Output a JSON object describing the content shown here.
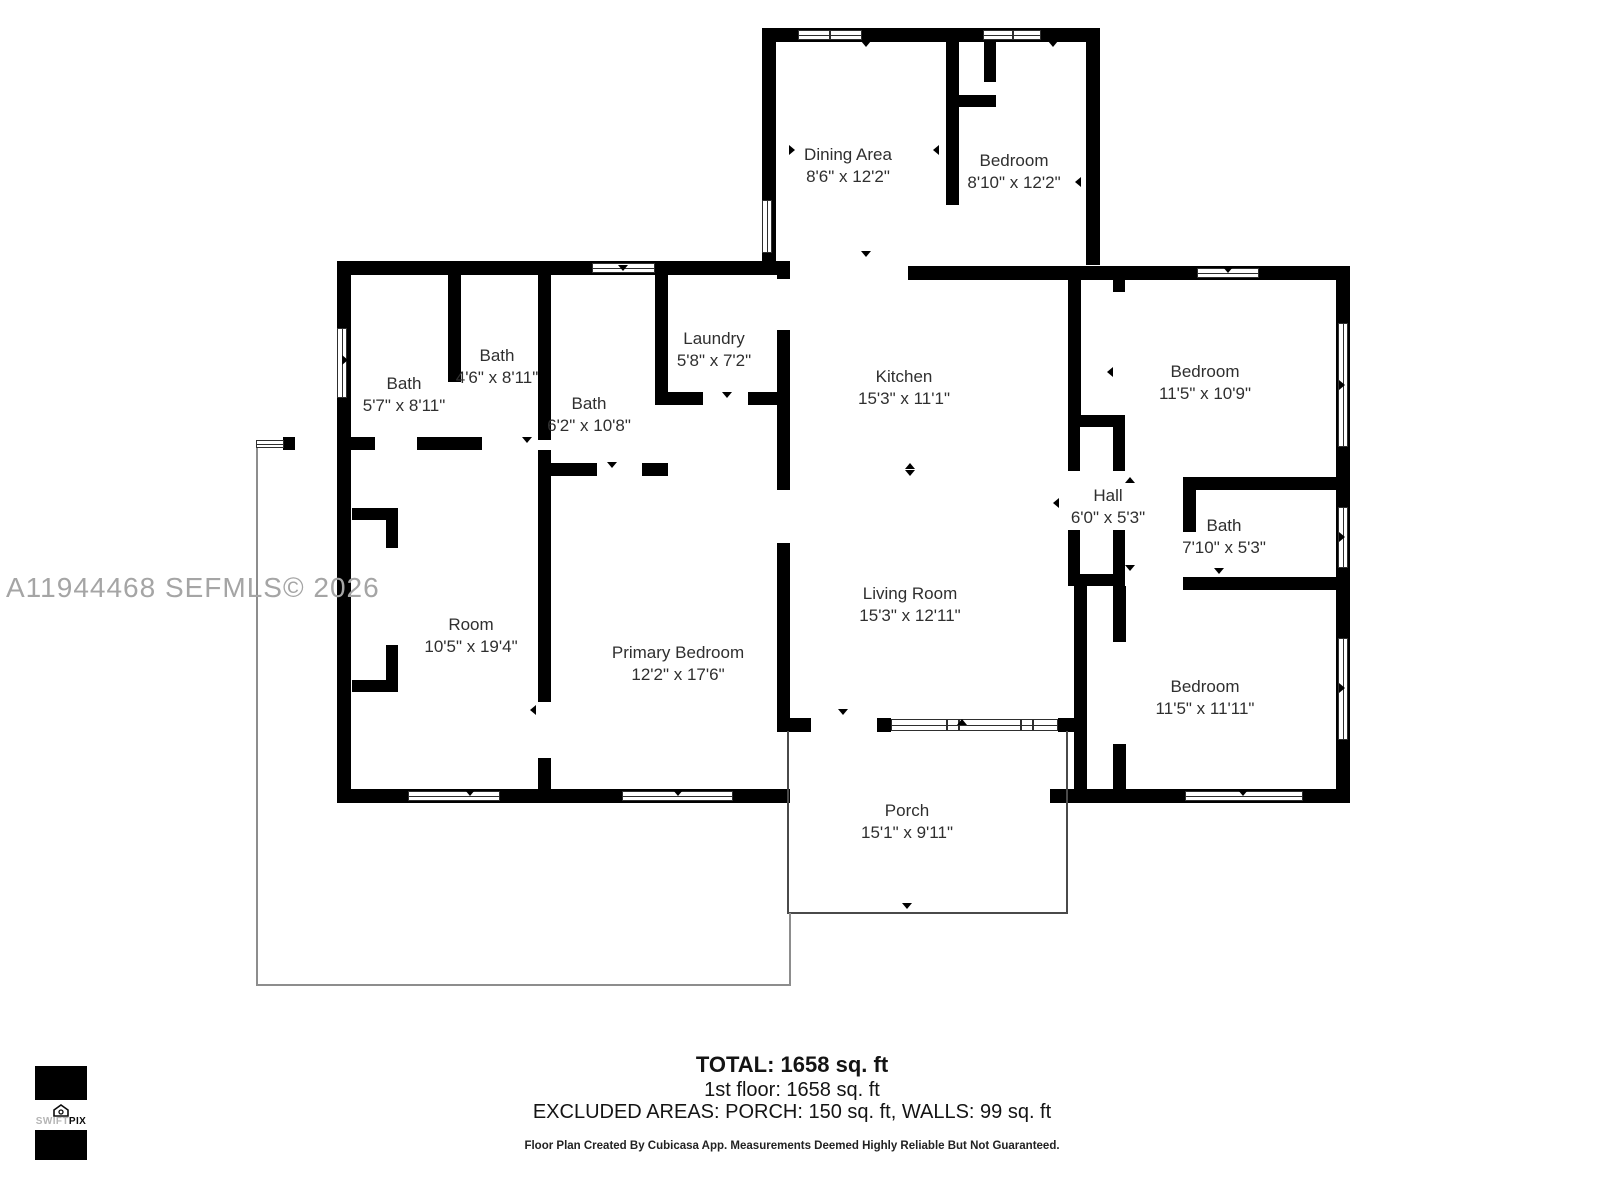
{
  "watermark": "A11944468  SEFMLS© 2026",
  "rooms": [
    {
      "name": "Dining Area",
      "dims": "8'6\" x 12'2\""
    },
    {
      "name": "Bedroom",
      "dims": "8'10\" x 12'2\""
    },
    {
      "name": "Bath",
      "dims": "5'7\" x 8'11\""
    },
    {
      "name": "Bath",
      "dims": "4'6\" x 8'11\""
    },
    {
      "name": "Bath",
      "dims": "6'2\" x 10'8\""
    },
    {
      "name": "Laundry",
      "dims": "5'8\" x 7'2\""
    },
    {
      "name": "Kitchen",
      "dims": "15'3\" x 11'1\""
    },
    {
      "name": "Bedroom",
      "dims": "11'5\" x 10'9\""
    },
    {
      "name": "Hall",
      "dims": "6'0\" x 5'3\""
    },
    {
      "name": "Bath",
      "dims": "7'10\" x 5'3\""
    },
    {
      "name": "Room",
      "dims": "10'5\" x 19'4\""
    },
    {
      "name": "Primary Bedroom",
      "dims": "12'2\" x 17'6\""
    },
    {
      "name": "Living Room",
      "dims": "15'3\" x 12'11\""
    },
    {
      "name": "Bedroom",
      "dims": "11'5\" x 11'11\""
    },
    {
      "name": "Porch",
      "dims": "15'1\" x 9'11\""
    }
  ],
  "summary": {
    "total": "TOTAL: 1658 sq. ft",
    "first_floor": "1st floor: 1658 sq. ft",
    "excluded": "EXCLUDED AREAS: PORCH: 150 sq. ft, WALLS: 99 sq. ft"
  },
  "disclaimer": "Floor Plan Created By Cubicasa App. Measurements Deemed Highly Reliable But Not Guaranteed.",
  "logo": {
    "brand_light": "SWIFT",
    "brand_bold": "PIX"
  },
  "colors": {
    "wall": "#000000",
    "watermark": "#a5a5a5",
    "label_text": "#2f2f2f"
  }
}
